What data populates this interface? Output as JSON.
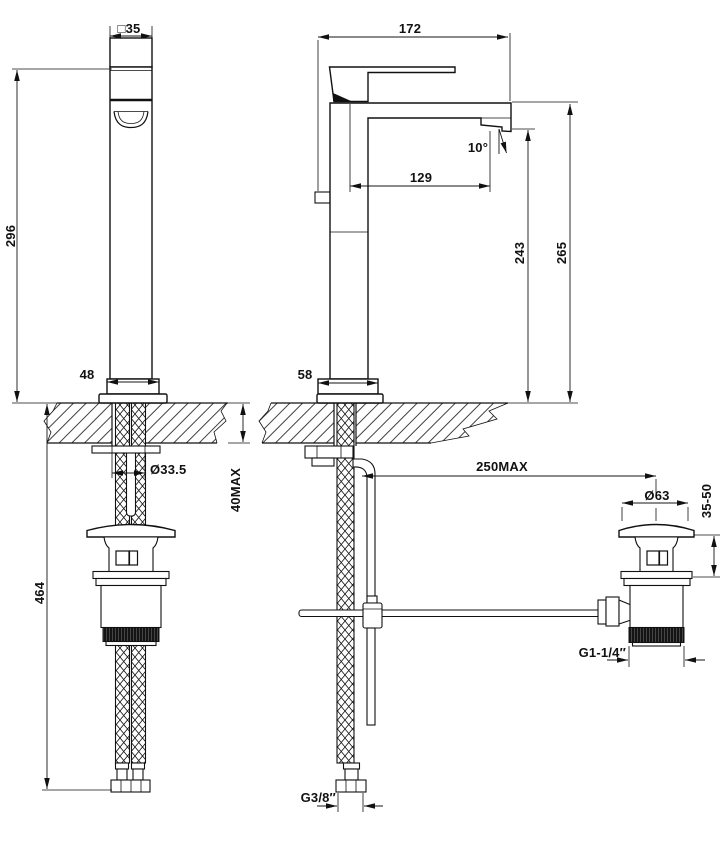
{
  "drawing": {
    "kind": "faucet-installation-dimensions",
    "front_view": {
      "handle_square_width": "□35",
      "height_above_counter": "296",
      "base_width": "48",
      "mounting_hole_diameter": "Ø33.5",
      "counter_thickness_max": "40MAX",
      "supply_hose_drop": "464"
    },
    "side_view": {
      "overall_depth": "172",
      "spout_projection": "129",
      "outlet_angle": "10°",
      "outlet_height_above_counter": "243",
      "spout_top_height_above_counter": "265",
      "base_depth": "58",
      "popup_rod_max_reach": "250MAX",
      "waste_cap_diameter": "Ø63",
      "waste_deck_thickness_range": "35-50",
      "waste_thread_size": "G1-1/4″",
      "supply_thread_size": "G3/8″"
    }
  }
}
